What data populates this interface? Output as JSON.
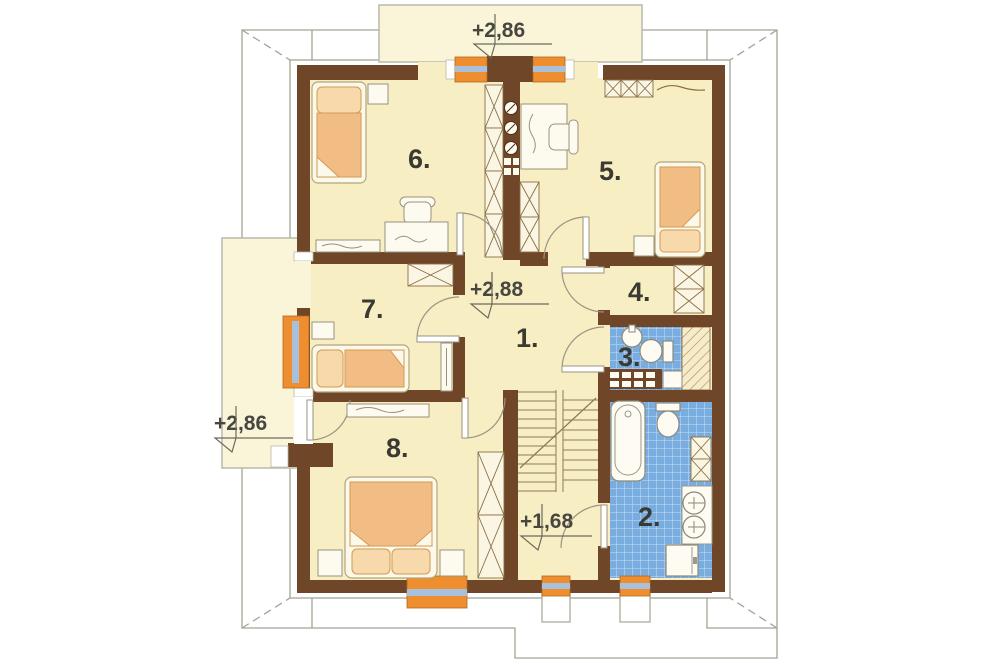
{
  "plan": {
    "type": "architectural-floor-plan-upper-storey",
    "rooms": [
      {
        "number": "6."
      },
      {
        "number": "5."
      },
      {
        "number": "7."
      },
      {
        "number": "1."
      },
      {
        "number": "4."
      },
      {
        "number": "3."
      },
      {
        "number": "8."
      },
      {
        "number": "2."
      }
    ],
    "levels": {
      "dormer_top": "+2,86",
      "dormer_left": "+2,86",
      "hall": "+2,88",
      "stair_landing": "+1,68"
    },
    "colors": {
      "wall": "#6f4627",
      "floor": "#f8eec4",
      "dormer": "#faf4d9",
      "tile": "#79acdf",
      "window_frame": "#ef8e2e",
      "window_glass": "#a9c0dc",
      "furniture": "#f2bd85",
      "pillow": "#f7d9ac",
      "outline": "#a3a396"
    },
    "symbols": [
      "single-bed",
      "double-bed",
      "desk-with-chair",
      "wardrobe",
      "shelf",
      "chimney-vents",
      "bathtub",
      "toilet",
      "washbasin",
      "washing-machine",
      "staircase",
      "door-swing",
      "window",
      "roof-outline",
      "level-marker"
    ]
  }
}
